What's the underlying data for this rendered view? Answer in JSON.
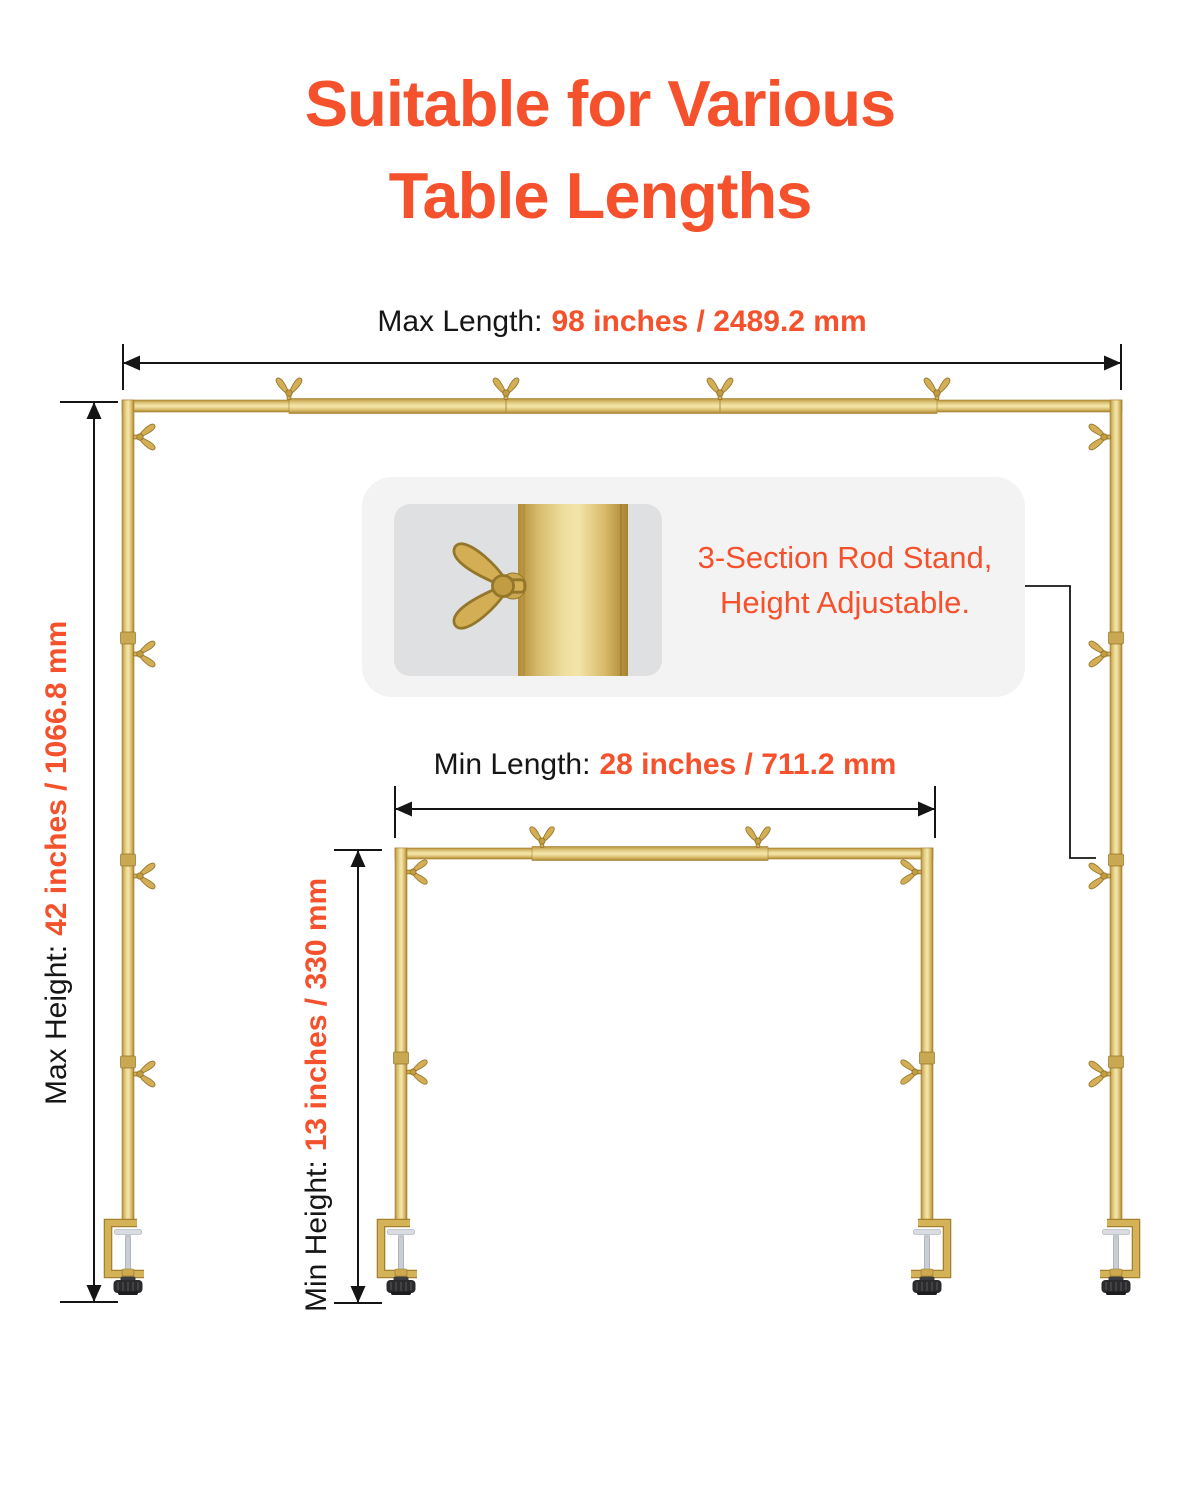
{
  "title": {
    "line1": "Suitable for Various",
    "line2": "Table Lengths"
  },
  "dimensions": {
    "max_length": {
      "label": "Max Length:",
      "value": "98 inches / 2489.2 mm"
    },
    "max_height": {
      "label": "Max Height:",
      "value": "42 inches / 1066.8 mm"
    },
    "min_length": {
      "label": "Min Length:",
      "value": "28 inches / 711.2 mm"
    },
    "min_height": {
      "label": "Min Height:",
      "value": "13 inches / 330 mm"
    }
  },
  "callout": {
    "line1": "3-Section Rod Stand,",
    "line2": "Height Adjustable."
  },
  "colors": {
    "accent": "#F4512C",
    "text": "#161616",
    "gold_light": "#F3E4A8",
    "gold_mid": "#D9BC6C",
    "gold_dark": "#A8822E",
    "callout_bg": "#F3F3F4",
    "callout_image_bg": "#DFE0E1",
    "knob_black": "#2B2B2E",
    "screw_silver": "#D9DDE1"
  },
  "icon_names": {
    "fastener": "wing-nut-icon",
    "mount": "c-clamp-icon",
    "measure": "dimension-arrow"
  }
}
